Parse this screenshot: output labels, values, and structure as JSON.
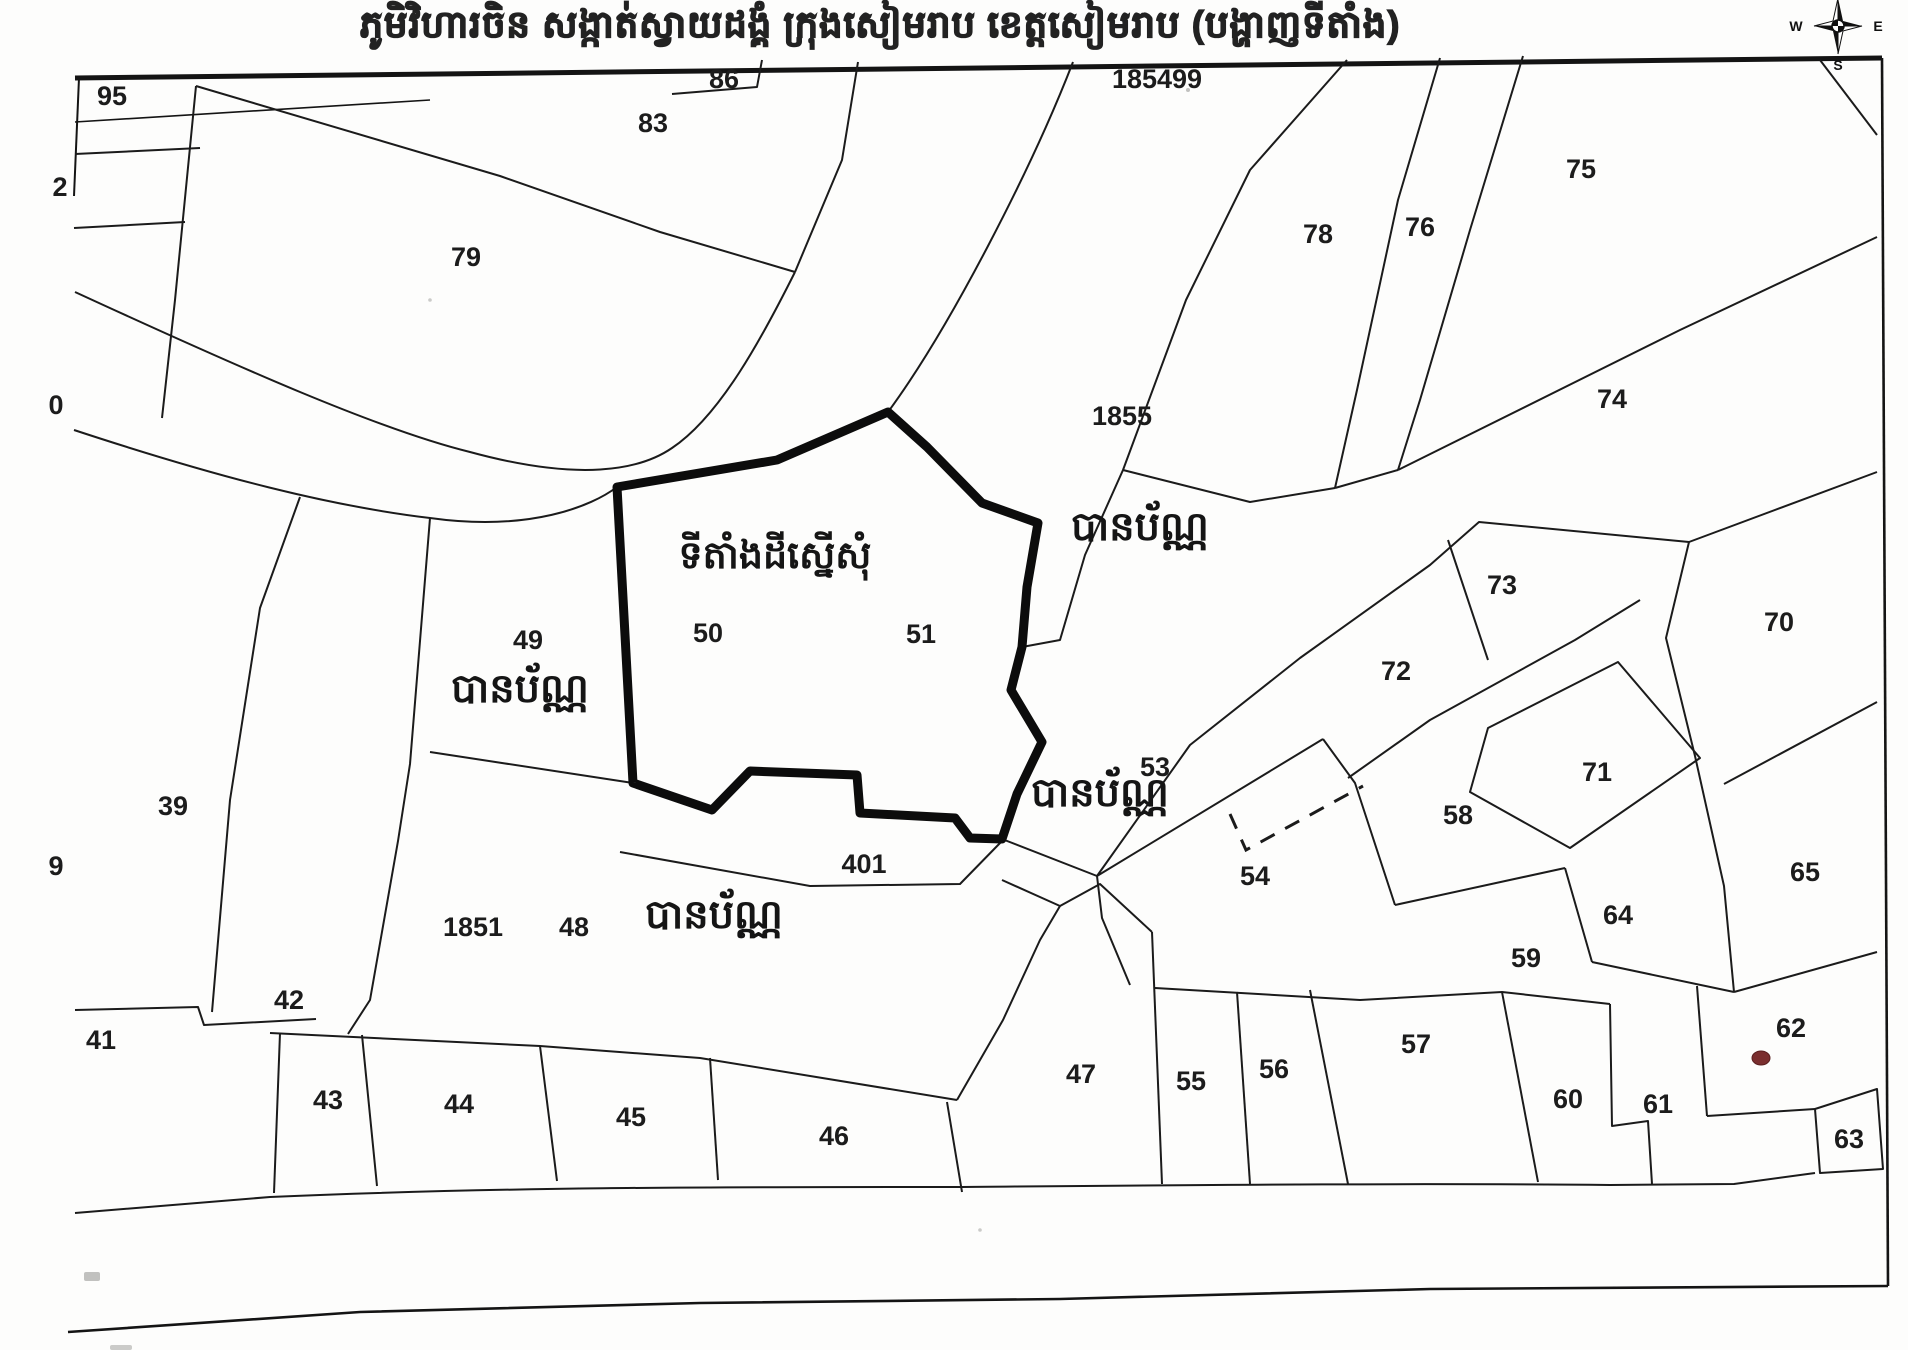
{
  "title": "ភូមិវិហារចិន សង្កាត់ស្វាយដង្គំ ក្រុងសៀមរាប ខេត្តសៀមរាប (បង្ហាញទីតាំង)",
  "compass": {
    "west": "W",
    "east": "E",
    "south": "S"
  },
  "map": {
    "site_label": {
      "text": "ទីតាំងដីស្នើសុំ",
      "x": 775,
      "y": 568
    },
    "area_status_labels": [
      {
        "text": "បានប័ណ្ណ",
        "x": 1140,
        "y": 540
      },
      {
        "text": "បានប័ណ្ណ",
        "x": 520,
        "y": 702
      },
      {
        "text": "បានប័ណ្ណ",
        "x": 1100,
        "y": 806
      },
      {
        "text": "បានប័ណ្ណ",
        "x": 714,
        "y": 928
      }
    ],
    "parcels": [
      {
        "id": "95",
        "x": 112,
        "y": 105
      },
      {
        "id": "2",
        "x": 60,
        "y": 196
      },
      {
        "id": "0",
        "x": 56,
        "y": 414
      },
      {
        "id": "9",
        "x": 56,
        "y": 875
      },
      {
        "id": "83",
        "x": 653,
        "y": 132
      },
      {
        "id": "86",
        "x": 724,
        "y": 88
      },
      {
        "id": "185499",
        "x": 1157,
        "y": 88
      },
      {
        "id": "79",
        "x": 466,
        "y": 266
      },
      {
        "id": "78",
        "x": 1318,
        "y": 243
      },
      {
        "id": "76",
        "x": 1420,
        "y": 236
      },
      {
        "id": "75",
        "x": 1581,
        "y": 178
      },
      {
        "id": "74",
        "x": 1612,
        "y": 408
      },
      {
        "id": "1855",
        "x": 1122,
        "y": 425
      },
      {
        "id": "73",
        "x": 1502,
        "y": 594
      },
      {
        "id": "70",
        "x": 1779,
        "y": 631
      },
      {
        "id": "72",
        "x": 1396,
        "y": 680
      },
      {
        "id": "49",
        "x": 528,
        "y": 649
      },
      {
        "id": "50",
        "x": 708,
        "y": 642
      },
      {
        "id": "51",
        "x": 921,
        "y": 643
      },
      {
        "id": "39",
        "x": 173,
        "y": 815
      },
      {
        "id": "71",
        "x": 1597,
        "y": 781
      },
      {
        "id": "53",
        "x": 1155,
        "y": 776
      },
      {
        "id": "58",
        "x": 1458,
        "y": 824
      },
      {
        "id": "65",
        "x": 1805,
        "y": 881
      },
      {
        "id": "54",
        "x": 1255,
        "y": 885
      },
      {
        "id": "64",
        "x": 1618,
        "y": 924
      },
      {
        "id": "59",
        "x": 1526,
        "y": 967
      },
      {
        "id": "401",
        "x": 864,
        "y": 873
      },
      {
        "id": "1851",
        "x": 473,
        "y": 936
      },
      {
        "id": "48",
        "x": 574,
        "y": 936
      },
      {
        "id": "42",
        "x": 289,
        "y": 1009
      },
      {
        "id": "41",
        "x": 101,
        "y": 1049
      },
      {
        "id": "43",
        "x": 328,
        "y": 1109
      },
      {
        "id": "44",
        "x": 459,
        "y": 1113
      },
      {
        "id": "45",
        "x": 631,
        "y": 1126
      },
      {
        "id": "46",
        "x": 834,
        "y": 1145
      },
      {
        "id": "47",
        "x": 1081,
        "y": 1083
      },
      {
        "id": "55",
        "x": 1191,
        "y": 1090
      },
      {
        "id": "56",
        "x": 1274,
        "y": 1078
      },
      {
        "id": "57",
        "x": 1416,
        "y": 1053
      },
      {
        "id": "60",
        "x": 1568,
        "y": 1108
      },
      {
        "id": "61",
        "x": 1658,
        "y": 1113
      },
      {
        "id": "62",
        "x": 1791,
        "y": 1037
      },
      {
        "id": "63",
        "x": 1849,
        "y": 1148
      }
    ],
    "marker": {
      "x": 1761,
      "y": 1058,
      "color": "#7a2e2e"
    },
    "colors": {
      "line": "#1b1b1b",
      "bold_outline": "#0c0c0c",
      "paper": "#fdfdfc"
    }
  }
}
